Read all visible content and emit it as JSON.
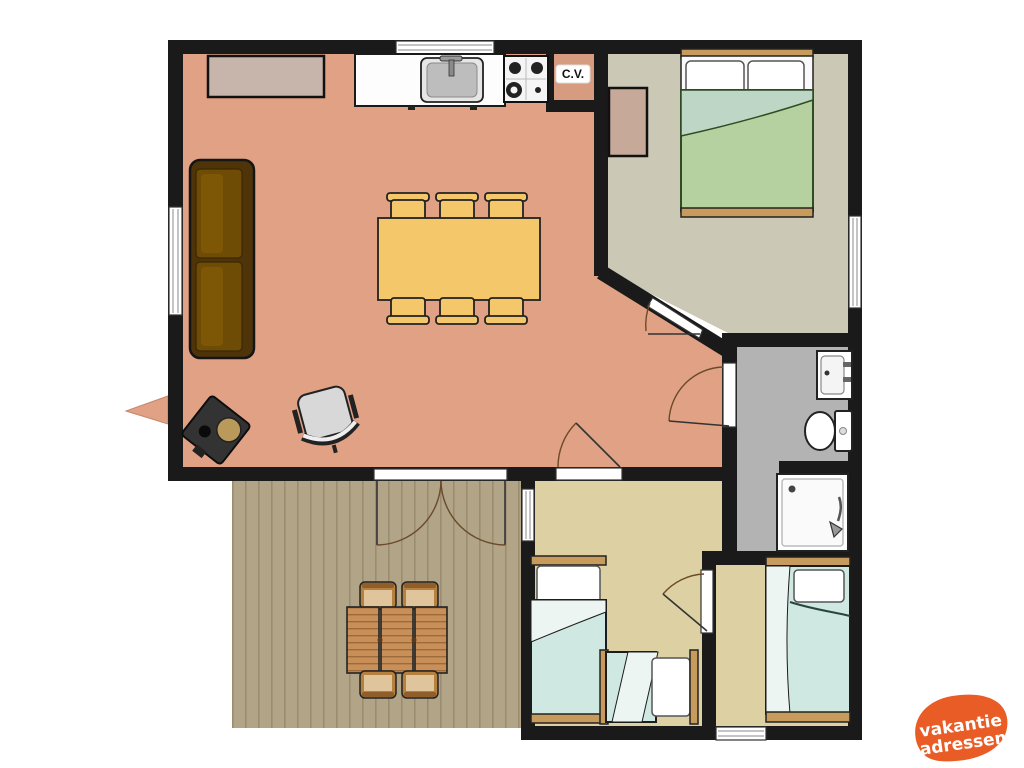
{
  "title": "holiday-home floor plan",
  "labels": {
    "cv": "C.V."
  },
  "logo": {
    "line1": "vakantie",
    "line2": "adressen"
  },
  "colors": {
    "wall": "#1a1a1a",
    "living_floor": "#e0a184",
    "cv_floor": "#d79c80",
    "master_floor": "#ccc8b6",
    "bedroom_floor": "#ddd1a3",
    "bathroom_floor": "#b3b3b3",
    "deck_floor": "#b2a487",
    "deck_plank_line": "#9a8c70",
    "table_wood": "#f3c76a",
    "sofa_body": "#4e3408",
    "sofa_cushion": "#6f4c05",
    "bed_frame_wood": "#c79b5c",
    "duvet_teal": "#cfe8e1",
    "duvet_green": "#b6d1a0",
    "duvet_green_fold": "#bdd6c6",
    "outdoor_wood": "#c98f58",
    "logo_orange": "#e95c26"
  },
  "rooms": [
    {
      "id": "living-kitchen",
      "color": "#e0a184"
    },
    {
      "id": "cv-closet",
      "color": "#d79c80",
      "label": "C.V."
    },
    {
      "id": "master-bedroom",
      "color": "#ccc8b6"
    },
    {
      "id": "bathroom",
      "color": "#b3b3b3"
    },
    {
      "id": "bedroom-2",
      "color": "#ddd1a3"
    },
    {
      "id": "bedroom-3",
      "color": "#ddd1a3"
    },
    {
      "id": "deck",
      "color": "#b2a487"
    }
  ],
  "furniture": [
    "kitchen-counter",
    "kitchen-sink",
    "stove-4-burner",
    "sideboard",
    "sofa",
    "dining-table",
    "dining-chairs-x6",
    "office-chair",
    "wood-stove",
    "double-bed",
    "wardrobe",
    "wash-basin",
    "toilet",
    "shower",
    "single-bed-a",
    "single-bed-b",
    "single-bed-c",
    "outdoor-table",
    "outdoor-chairs-x4"
  ]
}
